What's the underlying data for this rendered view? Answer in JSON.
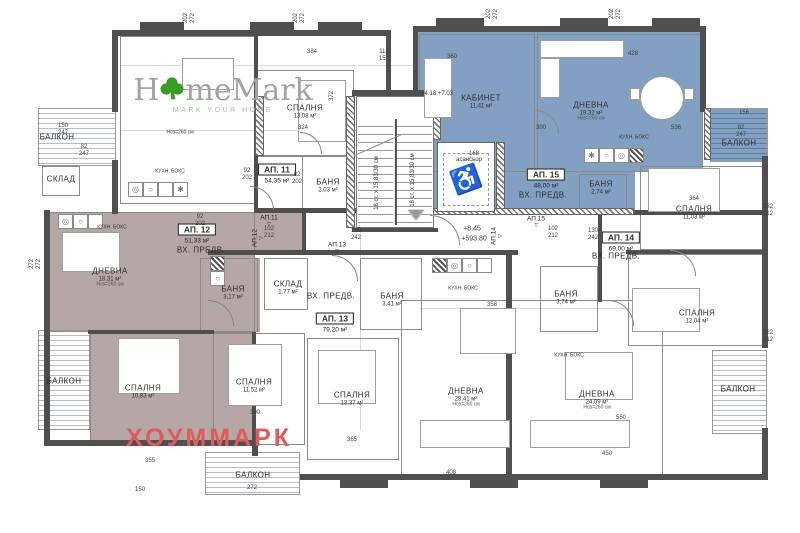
{
  "colors": {
    "wall": "#4f4f4f",
    "apartment_blue": "#82a0c2",
    "apartment_mauve": "#b5a7a5",
    "logo_gray": "#a3a3a3",
    "logo_green": "#3a9d23",
    "logo_green_light": "#9dc89d",
    "watermark_red": "#e05b5b"
  },
  "logo": {
    "part1": "H",
    "part2": "meMark",
    "tagline": "MARK YOUR HOME"
  },
  "watermark": {
    "text": "ХОУММАРК"
  },
  "elevator": {
    "label": "асансьор",
    "width_dim": "168"
  },
  "stairs": {
    "flight1": "18 ст. х 15,83/30 см",
    "flight2": "18 ст. х 15,83/30 см"
  },
  "apartment_tags": [
    {
      "label": "АП. 11",
      "area": "54,35 м²",
      "x": 277,
      "y": 172
    },
    {
      "label": "АП. 12",
      "area": "51,33 м²",
      "x": 197,
      "y": 232
    },
    {
      "label": "АП. 13",
      "area": "79,20 м²",
      "x": 335,
      "y": 321
    },
    {
      "label": "АП. 14",
      "area": "69,00 м²",
      "x": 621,
      "y": 240
    },
    {
      "label": "АП. 15",
      "area": "48,00 м²",
      "x": 546,
      "y": 177
    }
  ],
  "rooms": [
    {
      "name": "СПАЛНЯ",
      "area": "13,08 м²",
      "x": 305,
      "y": 112
    },
    {
      "name": "БАНЯ",
      "area": "2,03 м²",
      "x": 328,
      "y": 186
    },
    {
      "name": "ДНЕВНА",
      "area": "18,31 м²",
      "note": "Hсв=260 см",
      "x": 110,
      "y": 278
    },
    {
      "name": "СПАЛНЯ",
      "area": "10,83 м²",
      "x": 143,
      "y": 392
    },
    {
      "name": "БАНЯ",
      "area": "3,17 м²",
      "x": 233,
      "y": 293
    },
    {
      "name": "СКЛАД",
      "area": "1,77 м²",
      "x": 288,
      "y": 288
    },
    {
      "name": "ВХ. ПРЕДВ.",
      "x": 201,
      "y": 251
    },
    {
      "name": "БАНЯ",
      "area": "3,41 м²",
      "x": 392,
      "y": 300
    },
    {
      "name": "ВХ. ПРЕДВ.",
      "x": 331,
      "y": 297
    },
    {
      "name": "СПАЛНЯ",
      "area": "11,52 м²",
      "x": 254,
      "y": 386
    },
    {
      "name": "СПАЛНЯ",
      "area": "13,37 м²",
      "x": 352,
      "y": 399
    },
    {
      "name": "ДНЕВНА",
      "area": "28,41 м²",
      "note": "Hсв=260 см",
      "x": 466,
      "y": 398
    },
    {
      "name": "БАНЯ",
      "area": "3,74 м²",
      "x": 566,
      "y": 298
    },
    {
      "name": "ДНЕВНА",
      "area": "24,09 м²",
      "note": "Hсв=260 см",
      "x": 597,
      "y": 401
    },
    {
      "name": "СПАЛНЯ",
      "area": "12,04 м²",
      "x": 697,
      "y": 317
    },
    {
      "name": "СПАЛНЯ",
      "area": "11,03 м²",
      "x": 694,
      "y": 213
    },
    {
      "name": "ВХ. ПРЕДВ.",
      "x": 616,
      "y": 257
    },
    {
      "name": "БАНЯ",
      "area": "2,74 м²",
      "x": 601,
      "y": 188
    },
    {
      "name": "ВХ. ПРЕДВ.",
      "x": 543,
      "y": 196
    },
    {
      "name": "КАБИНЕТ",
      "area": "11,41 м²",
      "x": 481,
      "y": 102
    },
    {
      "name": "ДНЕВНА",
      "area": "19,32 м²",
      "note": "Hсв=260 см",
      "x": 591,
      "y": 112
    },
    {
      "name": "БАЛКОН",
      "x": 57,
      "y": 138
    },
    {
      "name": "СКЛАД",
      "x": 61,
      "y": 180
    },
    {
      "name": "БАЛКОН",
      "x": 64,
      "y": 382
    },
    {
      "name": "БАЛКОН",
      "x": 253,
      "y": 476
    },
    {
      "name": "БАЛКОН",
      "x": 739,
      "y": 144
    },
    {
      "name": "БАЛКОН",
      "x": 738,
      "y": 390
    }
  ],
  "entrance_markers": [
    {
      "label": "АП.11",
      "x": 269,
      "y": 221,
      "rot": 0
    },
    {
      "label": "АП.12",
      "x": 258,
      "y": 238,
      "rot": -90
    },
    {
      "label": "АП.13",
      "x": 337,
      "y": 248,
      "rot": 0
    },
    {
      "label": "АП.14",
      "x": 497,
      "y": 236,
      "rot": -90
    },
    {
      "label": "АП.15",
      "x": 536,
      "y": 222,
      "rot": 0
    }
  ],
  "misc_labels": [
    {
      "text": "асансьор",
      "x": 469,
      "y": 160,
      "size": 6
    },
    {
      "text": "Hсв=260 см",
      "x": 180,
      "y": 133,
      "size": 5
    },
    {
      "text": "КУХН. БОКС",
      "x": 170,
      "y": 172,
      "size": 5
    },
    {
      "text": "КУХН. БОКС",
      "x": 112,
      "y": 228,
      "size": 5
    },
    {
      "text": "КУХН. БОКС",
      "x": 634,
      "y": 138,
      "size": 5
    },
    {
      "text": "КУХН. БОКС",
      "x": 463,
      "y": 289,
      "size": 5
    },
    {
      "text": "КУХН. БОКС",
      "x": 569,
      "y": 356,
      "size": 5
    },
    {
      "text": "+4.18:+7.03",
      "x": 437,
      "y": 94,
      "size": 6
    },
    {
      "text": "+8.45",
      "x": 472,
      "y": 229,
      "size": 7
    },
    {
      "text": "+593.80",
      "x": 474,
      "y": 239,
      "size": 7
    },
    {
      "text": "18 ст. х 15,83/30 см",
      "x": 377,
      "y": 183,
      "rot": -90,
      "size": 6
    },
    {
      "text": "18 ст. х 15,83/30 см",
      "x": 413,
      "y": 180,
      "rot": -90,
      "size": 6
    }
  ],
  "dimensions": [
    {
      "text": "202",
      "x": 186,
      "y": 18,
      "rot": -90
    },
    {
      "text": "272",
      "x": 193,
      "y": 18,
      "rot": -90
    },
    {
      "text": "202",
      "x": 296,
      "y": 18,
      "rot": -90
    },
    {
      "text": "272",
      "x": 303,
      "y": 18,
      "rot": -90
    },
    {
      "text": "202",
      "x": 489,
      "y": 14,
      "rot": -90
    },
    {
      "text": "272",
      "x": 496,
      "y": 14,
      "rot": -90
    },
    {
      "text": "202",
      "x": 612,
      "y": 14,
      "rot": -90
    },
    {
      "text": "272",
      "x": 619,
      "y": 14,
      "rot": -90
    },
    {
      "text": "384",
      "x": 312,
      "y": 52
    },
    {
      "text": "112",
      "x": 384,
      "y": 52
    },
    {
      "text": "157",
      "x": 384,
      "y": 59
    },
    {
      "text": "372",
      "x": 332,
      "y": 96,
      "rot": -90
    },
    {
      "text": "324",
      "x": 303,
      "y": 128
    },
    {
      "text": "150",
      "x": 63,
      "y": 126
    },
    {
      "text": "247",
      "x": 63,
      "y": 133
    },
    {
      "text": "82",
      "x": 84,
      "y": 147
    },
    {
      "text": "247",
      "x": 84,
      "y": 154
    },
    {
      "text": "360",
      "x": 452,
      "y": 57
    },
    {
      "text": "428",
      "x": 633,
      "y": 54
    },
    {
      "text": "300",
      "x": 541,
      "y": 128
    },
    {
      "text": "538",
      "x": 676,
      "y": 128
    },
    {
      "text": "156",
      "x": 744,
      "y": 113
    },
    {
      "text": "82",
      "x": 741,
      "y": 128
    },
    {
      "text": "247",
      "x": 741,
      "y": 135
    },
    {
      "text": "92",
      "x": 247,
      "y": 171
    },
    {
      "text": "202",
      "x": 247,
      "y": 178
    },
    {
      "text": "82",
      "x": 297,
      "y": 175
    },
    {
      "text": "202",
      "x": 297,
      "y": 182
    },
    {
      "text": "92",
      "x": 200,
      "y": 217
    },
    {
      "text": "202",
      "x": 200,
      "y": 224
    },
    {
      "text": "102",
      "x": 269,
      "y": 229
    },
    {
      "text": "212",
      "x": 269,
      "y": 236
    },
    {
      "text": "130",
      "x": 356,
      "y": 231
    },
    {
      "text": "242",
      "x": 356,
      "y": 238
    },
    {
      "text": "130",
      "x": 593,
      "y": 231
    },
    {
      "text": "242",
      "x": 593,
      "y": 238
    },
    {
      "text": "102",
      "x": 553,
      "y": 229
    },
    {
      "text": "212",
      "x": 553,
      "y": 236
    },
    {
      "text": "364",
      "x": 694,
      "y": 199
    },
    {
      "text": "232",
      "x": 768,
      "y": 207
    },
    {
      "text": "212",
      "x": 768,
      "y": 214
    },
    {
      "text": "222",
      "x": 768,
      "y": 333
    },
    {
      "text": "212",
      "x": 768,
      "y": 340
    },
    {
      "text": "358",
      "x": 492,
      "y": 305
    },
    {
      "text": "550",
      "x": 621,
      "y": 418
    },
    {
      "text": "450",
      "x": 607,
      "y": 454
    },
    {
      "text": "408",
      "x": 451,
      "y": 473
    },
    {
      "text": "300",
      "x": 255,
      "y": 413
    },
    {
      "text": "365",
      "x": 352,
      "y": 440
    },
    {
      "text": "355",
      "x": 150,
      "y": 461
    },
    {
      "text": "150",
      "x": 140,
      "y": 490
    },
    {
      "text": "272",
      "x": 252,
      "y": 488
    },
    {
      "text": "272",
      "x": 32,
      "y": 264,
      "rot": -90
    },
    {
      "text": "272",
      "x": 39,
      "y": 264,
      "rot": -90
    }
  ]
}
